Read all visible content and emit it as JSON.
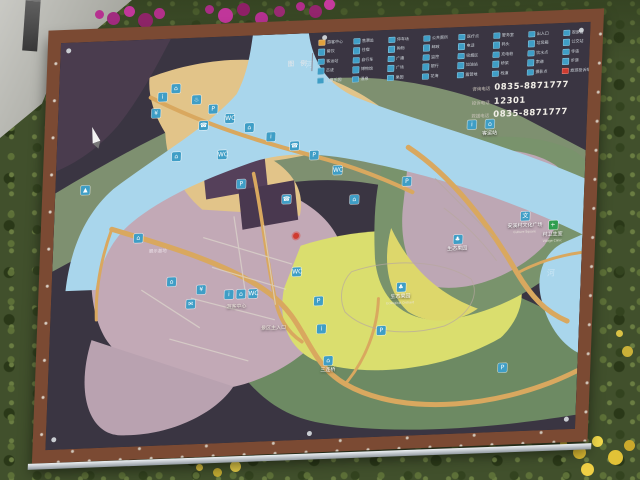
{
  "colors": {
    "frame": "#7b4a33",
    "panel": "#302b35",
    "water": "#a9d6ec",
    "town": "#e2c489",
    "mauve": "#c2a9b6",
    "orchard": "#dade6e",
    "green": "#7e9070",
    "road": "#d9a85f",
    "icon": "#3f9ec6",
    "red": "#cf3b30",
    "clinic": "#2e9e4f"
  },
  "board": {
    "legend": {
      "title": "图 例",
      "items": [
        {
          "label": "游客中心",
          "cls": "orange"
        },
        {
          "label": "售票处"
        },
        {
          "label": "停车场"
        },
        {
          "label": "公共厕所"
        },
        {
          "label": "医疗点"
        },
        {
          "label": "警务室"
        },
        {
          "label": "出入口"
        },
        {
          "label": "观景台"
        },
        {
          "label": "餐饮"
        },
        {
          "label": "住宿"
        },
        {
          "label": "购物"
        },
        {
          "label": "邮政"
        },
        {
          "label": "电话"
        },
        {
          "label": "码头"
        },
        {
          "label": "垃圾箱"
        },
        {
          "label": "公交站"
        },
        {
          "label": "客运站"
        },
        {
          "label": "自行车"
        },
        {
          "label": "广播"
        },
        {
          "label": "监控"
        },
        {
          "label": "吸烟区"
        },
        {
          "label": "充电桩"
        },
        {
          "label": "饮水点"
        },
        {
          "label": "寺庙"
        },
        {
          "label": "古迹"
        },
        {
          "label": "博物馆"
        },
        {
          "label": "广场"
        },
        {
          "label": "银行"
        },
        {
          "label": "加油站"
        },
        {
          "label": "桥梁"
        },
        {
          "label": "索道"
        },
        {
          "label": "步道"
        },
        {
          "label": "儿童乐园"
        },
        {
          "label": "温泉"
        },
        {
          "label": "果园"
        },
        {
          "label": "花海"
        },
        {
          "label": "露营地"
        },
        {
          "label": "栈道"
        },
        {
          "label": "摄影点"
        },
        {
          "label": "旅游投诉举报",
          "cls": "red"
        }
      ]
    },
    "contacts": {
      "rows": [
        {
          "label": "咨询电话",
          "value": "0835-8871777"
        },
        {
          "label": "投诉电话",
          "value": "12301"
        },
        {
          "label": "救援电话",
          "value": "0835-8871777"
        }
      ]
    },
    "pois": [
      {
        "x": 104,
        "y": 58,
        "glyph": "i",
        "label": ""
      },
      {
        "x": 117,
        "y": 50,
        "glyph": "⌂",
        "label": ""
      },
      {
        "x": 138,
        "y": 62,
        "glyph": "♨",
        "label": ""
      },
      {
        "x": 98,
        "y": 74,
        "glyph": "¥",
        "label": ""
      },
      {
        "x": 155,
        "y": 72,
        "glyph": "P",
        "label": ""
      },
      {
        "x": 172,
        "y": 82,
        "glyph": "WC",
        "label": ""
      },
      {
        "x": 146,
        "y": 88,
        "glyph": "☎",
        "label": ""
      },
      {
        "x": 192,
        "y": 92,
        "glyph": "⌂",
        "label": ""
      },
      {
        "x": 214,
        "y": 102,
        "glyph": "i",
        "label": ""
      },
      {
        "x": 238,
        "y": 112,
        "glyph": "☎",
        "label": ""
      },
      {
        "x": 258,
        "y": 122,
        "glyph": "P",
        "label": ""
      },
      {
        "x": 282,
        "y": 138,
        "glyph": "WC",
        "label": ""
      },
      {
        "x": 120,
        "y": 118,
        "glyph": "⌂",
        "label": ""
      },
      {
        "x": 166,
        "y": 118,
        "glyph": "WC",
        "label": ""
      },
      {
        "x": 186,
        "y": 148,
        "glyph": "P",
        "label": ""
      },
      {
        "x": 232,
        "y": 165,
        "glyph": "☎",
        "label": ""
      },
      {
        "x": 352,
        "y": 152,
        "glyph": "P",
        "label": ""
      },
      {
        "x": 300,
        "y": 168,
        "glyph": "⌂",
        "label": ""
      },
      {
        "x": 85,
        "y": 198,
        "glyph": "⌂",
        "label": ""
      },
      {
        "x": 245,
        "y": 238,
        "glyph": "WC",
        "label": ""
      },
      {
        "x": 268,
        "y": 268,
        "glyph": "P",
        "label": ""
      },
      {
        "x": 272,
        "y": 296,
        "glyph": "i",
        "label": ""
      },
      {
        "x": 150,
        "y": 252,
        "glyph": "¥",
        "label": ""
      },
      {
        "x": 140,
        "y": 266,
        "glyph": "✉",
        "label": ""
      },
      {
        "x": 120,
        "y": 243,
        "glyph": "⌂",
        "label": ""
      },
      {
        "x": 178,
        "y": 258,
        "glyph": "i",
        "label": ""
      },
      {
        "x": 190,
        "y": 258,
        "glyph": "⌂",
        "label": ""
      },
      {
        "x": 202,
        "y": 258,
        "glyph": "WC",
        "label": ""
      },
      {
        "x": 332,
        "y": 300,
        "glyph": "P",
        "label": ""
      },
      {
        "x": 455,
        "y": 342,
        "glyph": "P",
        "label": ""
      },
      {
        "x": 280,
        "y": 332,
        "glyph": "⌂",
        "label": "三连桥"
      },
      {
        "x": 350,
        "y": 264,
        "glyph": "♣",
        "label": "生态果园",
        "en": "Ecological Orchard"
      },
      {
        "x": 405,
        "y": 216,
        "glyph": "♣",
        "label": "生态果园"
      },
      {
        "x": 472,
        "y": 198,
        "glyph": "文",
        "label": "安溪村文化广场",
        "en": "Culture Square"
      },
      {
        "x": 500,
        "y": 208,
        "glyph": "+",
        "label": "村卫生室",
        "en": "Village Clinic",
        "cls": "green"
      },
      {
        "x": 433,
        "y": 102,
        "glyph": "⌂",
        "label": "客运站"
      },
      {
        "x": 415,
        "y": 98,
        "glyph": "i",
        "label": ""
      },
      {
        "x": 30,
        "y": 148,
        "glyph": "▲",
        "label": ""
      }
    ],
    "map_texts": [
      {
        "x": 186,
        "y": 270,
        "text": "游客中心",
        "cls": "small"
      },
      {
        "x": 224,
        "y": 293,
        "text": "景区主入口",
        "cls": "small"
      },
      {
        "x": 105,
        "y": 212,
        "text": "展示基地",
        "cls": "dim"
      },
      {
        "x": 250,
        "y": 32,
        "text": "河",
        "cls": "river"
      },
      {
        "x": 500,
        "y": 250,
        "text": "河",
        "cls": "river"
      }
    ],
    "marker": {
      "x": 243,
      "y": 202
    },
    "compass": {
      "x": 38,
      "y": 96
    }
  }
}
